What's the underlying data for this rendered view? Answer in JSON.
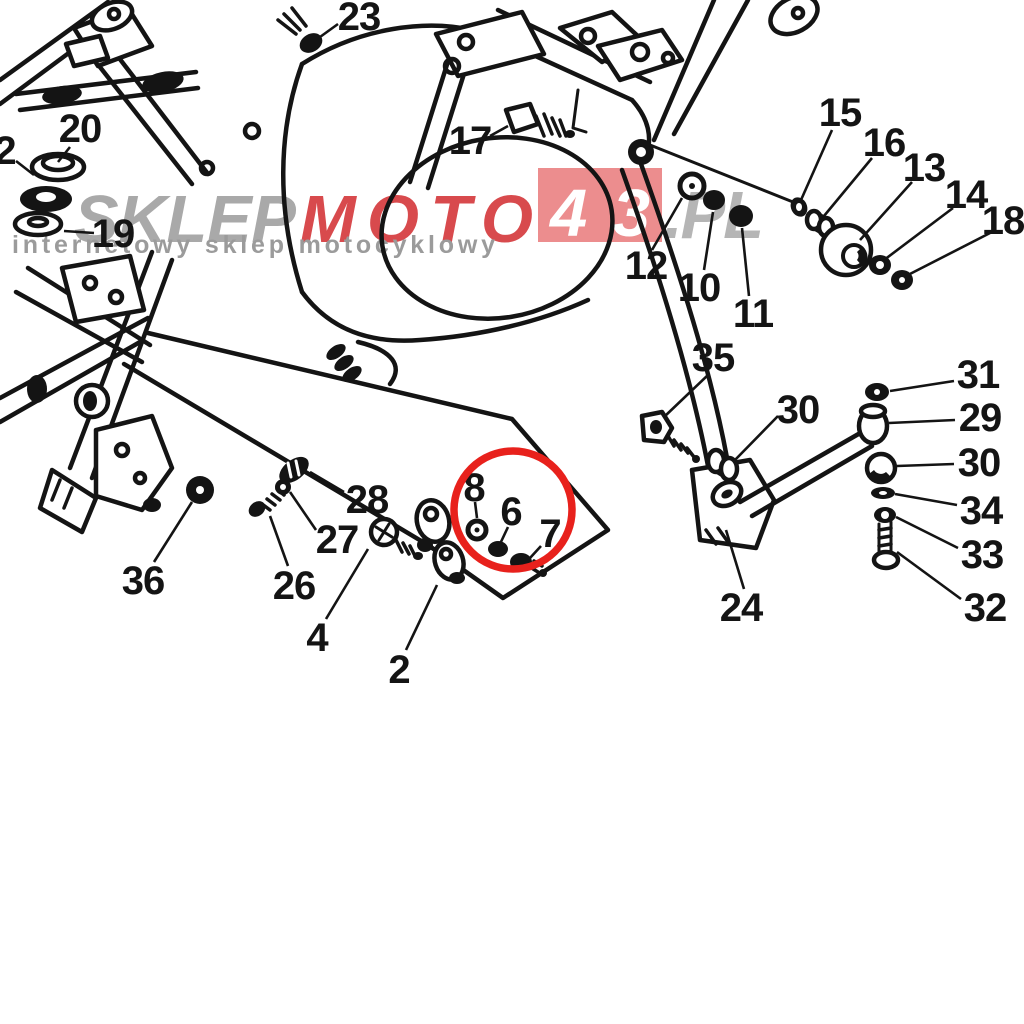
{
  "diagram": {
    "type": "exploded-parts-diagram",
    "subject": "Motorcycle frame and rear linkage exploded parts diagram",
    "background_color": "#ffffff",
    "line_color": "#141414",
    "highlight_circle": {
      "color": "#e8211c",
      "cx": 513,
      "cy": 510,
      "r": 59,
      "stroke_width": 7.5
    },
    "part_labels": [
      {
        "text": "23",
        "x": 359,
        "y": 17,
        "leader": {
          "x1": 338,
          "y1": 24,
          "x2": 320,
          "y2": 37
        }
      },
      {
        "text": "20",
        "x": 80,
        "y": 129,
        "leader": {
          "x1": 70,
          "y1": 147,
          "x2": 58,
          "y2": 162
        }
      },
      {
        "text": "2",
        "x": 5,
        "y": 151,
        "leader": {
          "x1": 16,
          "y1": 161,
          "x2": 34,
          "y2": 175
        }
      },
      {
        "text": "19",
        "x": 113,
        "y": 234,
        "leader": {
          "x1": 94,
          "y1": 233,
          "x2": 64,
          "y2": 231
        }
      },
      {
        "text": "17",
        "x": 470,
        "y": 141,
        "leader": {
          "x1": 490,
          "y1": 136,
          "x2": 508,
          "y2": 126
        }
      },
      {
        "text": "15",
        "x": 840,
        "y": 113,
        "leader": {
          "x1": 832,
          "y1": 130,
          "x2": 801,
          "y2": 200
        }
      },
      {
        "text": "16",
        "x": 884,
        "y": 143,
        "leader": {
          "x1": 872,
          "y1": 158,
          "x2": 824,
          "y2": 216
        }
      },
      {
        "text": "13",
        "x": 924,
        "y": 168,
        "leader": {
          "x1": 912,
          "y1": 182,
          "x2": 860,
          "y2": 240
        }
      },
      {
        "text": "14",
        "x": 966,
        "y": 195,
        "leader": {
          "x1": 953,
          "y1": 208,
          "x2": 884,
          "y2": 260
        }
      },
      {
        "text": "18",
        "x": 1003,
        "y": 221,
        "leader": {
          "x1": 990,
          "y1": 233,
          "x2": 906,
          "y2": 276
        }
      },
      {
        "text": "12",
        "x": 646,
        "y": 266,
        "leader": {
          "x1": 652,
          "y1": 250,
          "x2": 682,
          "y2": 198
        }
      },
      {
        "text": "10",
        "x": 699,
        "y": 288,
        "leader": {
          "x1": 704,
          "y1": 270,
          "x2": 713,
          "y2": 212
        }
      },
      {
        "text": "11",
        "x": 753,
        "y": 314,
        "leader": {
          "x1": 749,
          "y1": 296,
          "x2": 742,
          "y2": 228
        }
      },
      {
        "text": "35",
        "x": 713,
        "y": 358,
        "leader": {
          "x1": 708,
          "y1": 375,
          "x2": 664,
          "y2": 417
        }
      },
      {
        "text": "30",
        "x": 798,
        "y": 410,
        "leader": {
          "x1": 778,
          "y1": 416,
          "x2": 734,
          "y2": 461
        }
      },
      {
        "text": "31",
        "x": 978,
        "y": 375,
        "leader": {
          "x1": 954,
          "y1": 381,
          "x2": 890,
          "y2": 391
        }
      },
      {
        "text": "29",
        "x": 980,
        "y": 418,
        "leader": {
          "x1": 955,
          "y1": 420,
          "x2": 889,
          "y2": 423
        }
      },
      {
        "text": "30",
        "x": 979,
        "y": 463,
        "leader": {
          "x1": 954,
          "y1": 464,
          "x2": 897,
          "y2": 466
        }
      },
      {
        "text": "34",
        "x": 981,
        "y": 511,
        "leader": {
          "x1": 957,
          "y1": 505,
          "x2": 895,
          "y2": 494
        }
      },
      {
        "text": "33",
        "x": 982,
        "y": 555,
        "leader": {
          "x1": 958,
          "y1": 548,
          "x2": 896,
          "y2": 517
        }
      },
      {
        "text": "32",
        "x": 985,
        "y": 608,
        "leader": {
          "x1": 961,
          "y1": 599,
          "x2": 897,
          "y2": 552
        }
      },
      {
        "text": "24",
        "x": 741,
        "y": 608,
        "leader": {
          "x1": 744,
          "y1": 589,
          "x2": 726,
          "y2": 530
        }
      },
      {
        "text": "28",
        "x": 367,
        "y": 500,
        "leader": {
          "x1": 344,
          "y1": 492,
          "x2": 310,
          "y2": 472
        }
      },
      {
        "text": "27",
        "x": 337,
        "y": 540,
        "leader": {
          "x1": 316,
          "y1": 530,
          "x2": 290,
          "y2": 492
        }
      },
      {
        "text": "26",
        "x": 294,
        "y": 586,
        "leader": {
          "x1": 288,
          "y1": 566,
          "x2": 270,
          "y2": 516
        }
      },
      {
        "text": "36",
        "x": 143,
        "y": 581,
        "leader": {
          "x1": 154,
          "y1": 562,
          "x2": 192,
          "y2": 502
        }
      },
      {
        "text": "4",
        "x": 317,
        "y": 638,
        "leader": {
          "x1": 326,
          "y1": 619,
          "x2": 368,
          "y2": 549
        }
      },
      {
        "text": "2",
        "x": 399,
        "y": 670,
        "leader": {
          "x1": 406,
          "y1": 650,
          "x2": 437,
          "y2": 585
        }
      },
      {
        "text": "8",
        "x": 474,
        "y": 488,
        "leader": {
          "x1": 475,
          "y1": 502,
          "x2": 477,
          "y2": 518
        }
      },
      {
        "text": "6",
        "x": 511,
        "y": 512,
        "leader": {
          "x1": 508,
          "y1": 527,
          "x2": 500,
          "y2": 544
        }
      },
      {
        "text": "7",
        "x": 550,
        "y": 534,
        "leader": {
          "x1": 541,
          "y1": 546,
          "x2": 530,
          "y2": 558
        }
      }
    ]
  },
  "watermark": {
    "brand_gray": "SKLEP",
    "brand_red": "MOTO",
    "box_number": "43",
    "brand_suffix": ".PL",
    "slogan": "internetowy sklep motocyklowy",
    "colors": {
      "gray": "#a9a9a9",
      "red": "#d84a4d",
      "box_fill": "#ec8d8e",
      "box_text": "#ffffff",
      "suffix": "#b5b5b5",
      "slogan": "#9b9b9b"
    }
  }
}
